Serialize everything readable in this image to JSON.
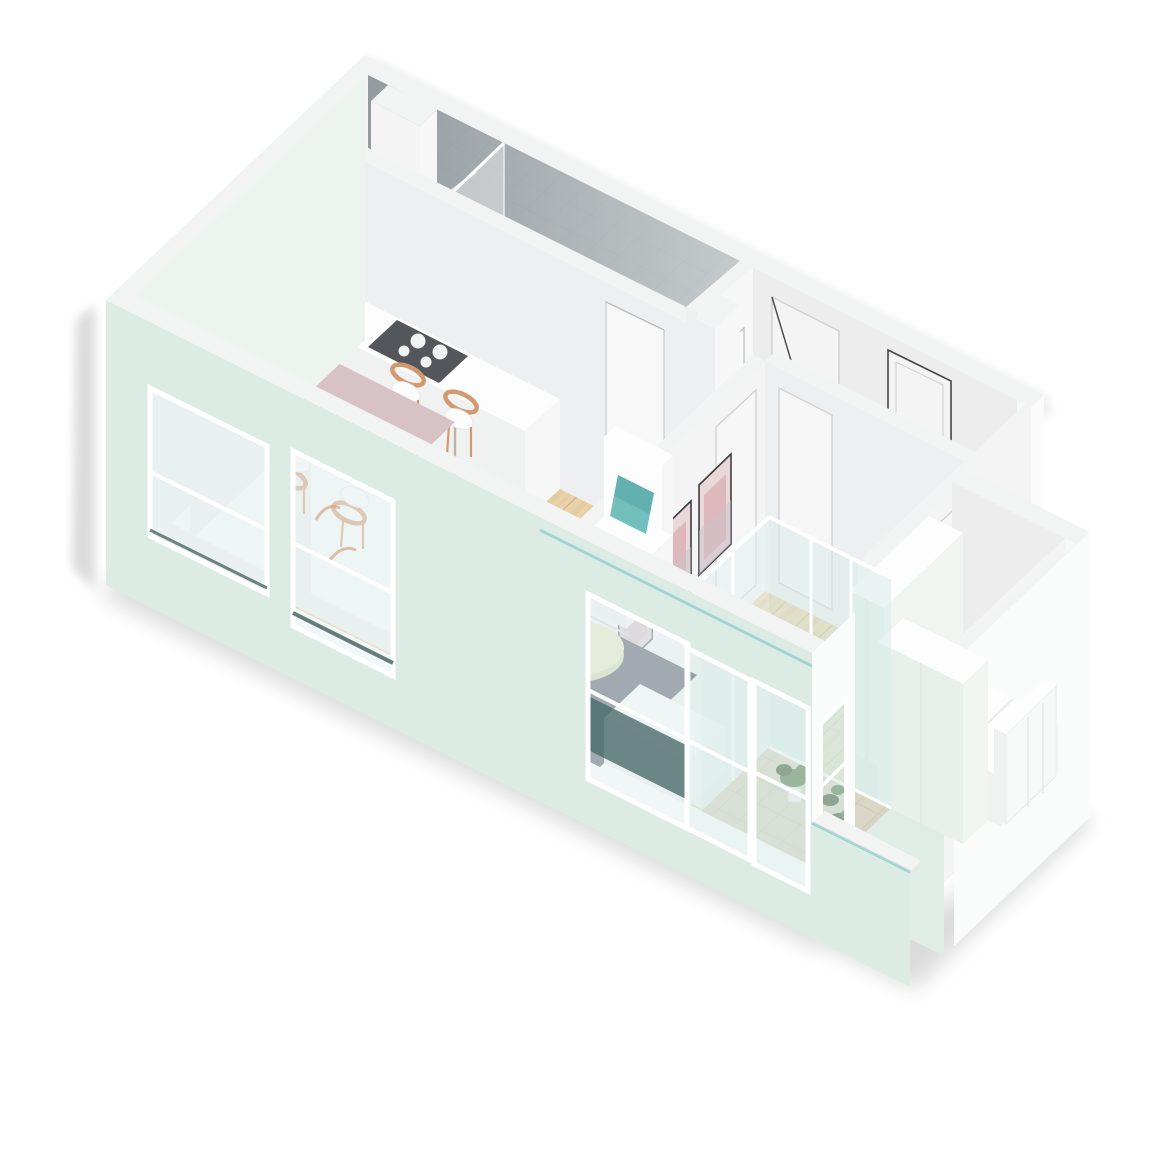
{
  "scene": {
    "type": "isometric-floorplan",
    "description": "3D isometric cutaway floor plan of an apartment, viewed from above at an angle, white and mint walls, light wood floors"
  },
  "palette": {
    "bg": "#ffffff",
    "wallTop": "#f2f3f3",
    "neOuter": "#f7f8f8",
    "nwOuter": "#edf4f0",
    "frontMint": "#dcebe4",
    "notchMint": "#e0ede7",
    "seWhite": "#fafbfb",
    "stepWhite": "#fbfbfc",
    "innerWhite": "#ededee",
    "innerLight": "#f4f4f5",
    "innerLit": "#f7f7f8",
    "innerShade": "#eeeff0",
    "frontInner": "#eef2ee",
    "showerA": "#878f93",
    "showerB": "#c9ced0",
    "tileBase": "#b9bec1",
    "tileLine": "#a7adb0",
    "woodBase": "#ead2aa",
    "woodMid": "#e0c498",
    "woodLine": "#d2b488",
    "terrBase": "#dad5c5",
    "terrLine": "#c8c2b2",
    "rug": "#48525e",
    "tableTop": "#d7c2c5",
    "tableLeg": "#c4aeb1",
    "chairWood": "#d09a6e",
    "seatWhite": "#fcfcfc",
    "cooktop": "#53575b",
    "burner": "#f2f3f3",
    "teal": "#72bfbe",
    "tealDark": "#4f9e9d",
    "coffee": "#e7e9c2",
    "coffeeSide": "#d5d7ad",
    "artLight": "#e9d8d9",
    "artPink": "#d9aeb3",
    "artGrey": "#c9c4cb",
    "frameDark": "#3f3f41",
    "frameLight": "#b9bcbd",
    "doorStroke": "#d2d2d2",
    "doorDark": "#454545",
    "doorFill": "#f4f4f4",
    "glassTint": "rgba(214,235,231,0.50)",
    "glassPale": "rgba(229,238,240,0.55)",
    "glassTeal": "#4a6b6a",
    "sillTeal": "#37544f",
    "plantGreen": "#5f7f55",
    "plantDark": "#47613f",
    "potWhite": "#f3f3f1",
    "potClay": "#d9c2b4",
    "dryPlant": "#c9a08e",
    "radWhite": "#f7f8f8",
    "wardrobeMint": "#e7f0eb",
    "wardrobeSide": "#f1f5f2",
    "furnWhite": "#fdfdfd",
    "furnShade": "#f0f1f1",
    "furnSide": "#f6f6f6",
    "pillowStroke": "#e3e3e3",
    "chrome": "#d8dadb",
    "shadow": "#1a1d1f"
  },
  "rooms": [
    {
      "id": "bathroom",
      "label": "Bathroom with walk-in shower",
      "floor": "grey tile"
    },
    {
      "id": "kitchen",
      "label": "Kitchen",
      "floor": "wood"
    },
    {
      "id": "living-dining",
      "label": "Open living / dining room",
      "floor": "wood"
    },
    {
      "id": "hallway",
      "label": "Entrance hall",
      "floor": "wood"
    },
    {
      "id": "bedroom-middle",
      "label": "Bedroom 2",
      "floor": "wood"
    },
    {
      "id": "bedroom-main",
      "label": "Bedroom 1",
      "floor": "wood"
    },
    {
      "id": "loggia",
      "label": "Glazed loggia / terrace",
      "floor": "beige tile"
    }
  ],
  "furniture": [
    "L-shaped kitchen counter with cooktop",
    "sink island with double round basin and faucet",
    "dining table with four wooden chairs",
    "white armchair with teal cushion",
    "round pale coffee table with two cups",
    "dark navy rug",
    "gallery of small picture frames",
    "three framed artworks",
    "white wardrobe",
    "white bench",
    "double bed with two pillows",
    "radiator panel",
    "mint wardrobe",
    "potted plants",
    "rain shower head with glass screen",
    "entrance door"
  ]
}
